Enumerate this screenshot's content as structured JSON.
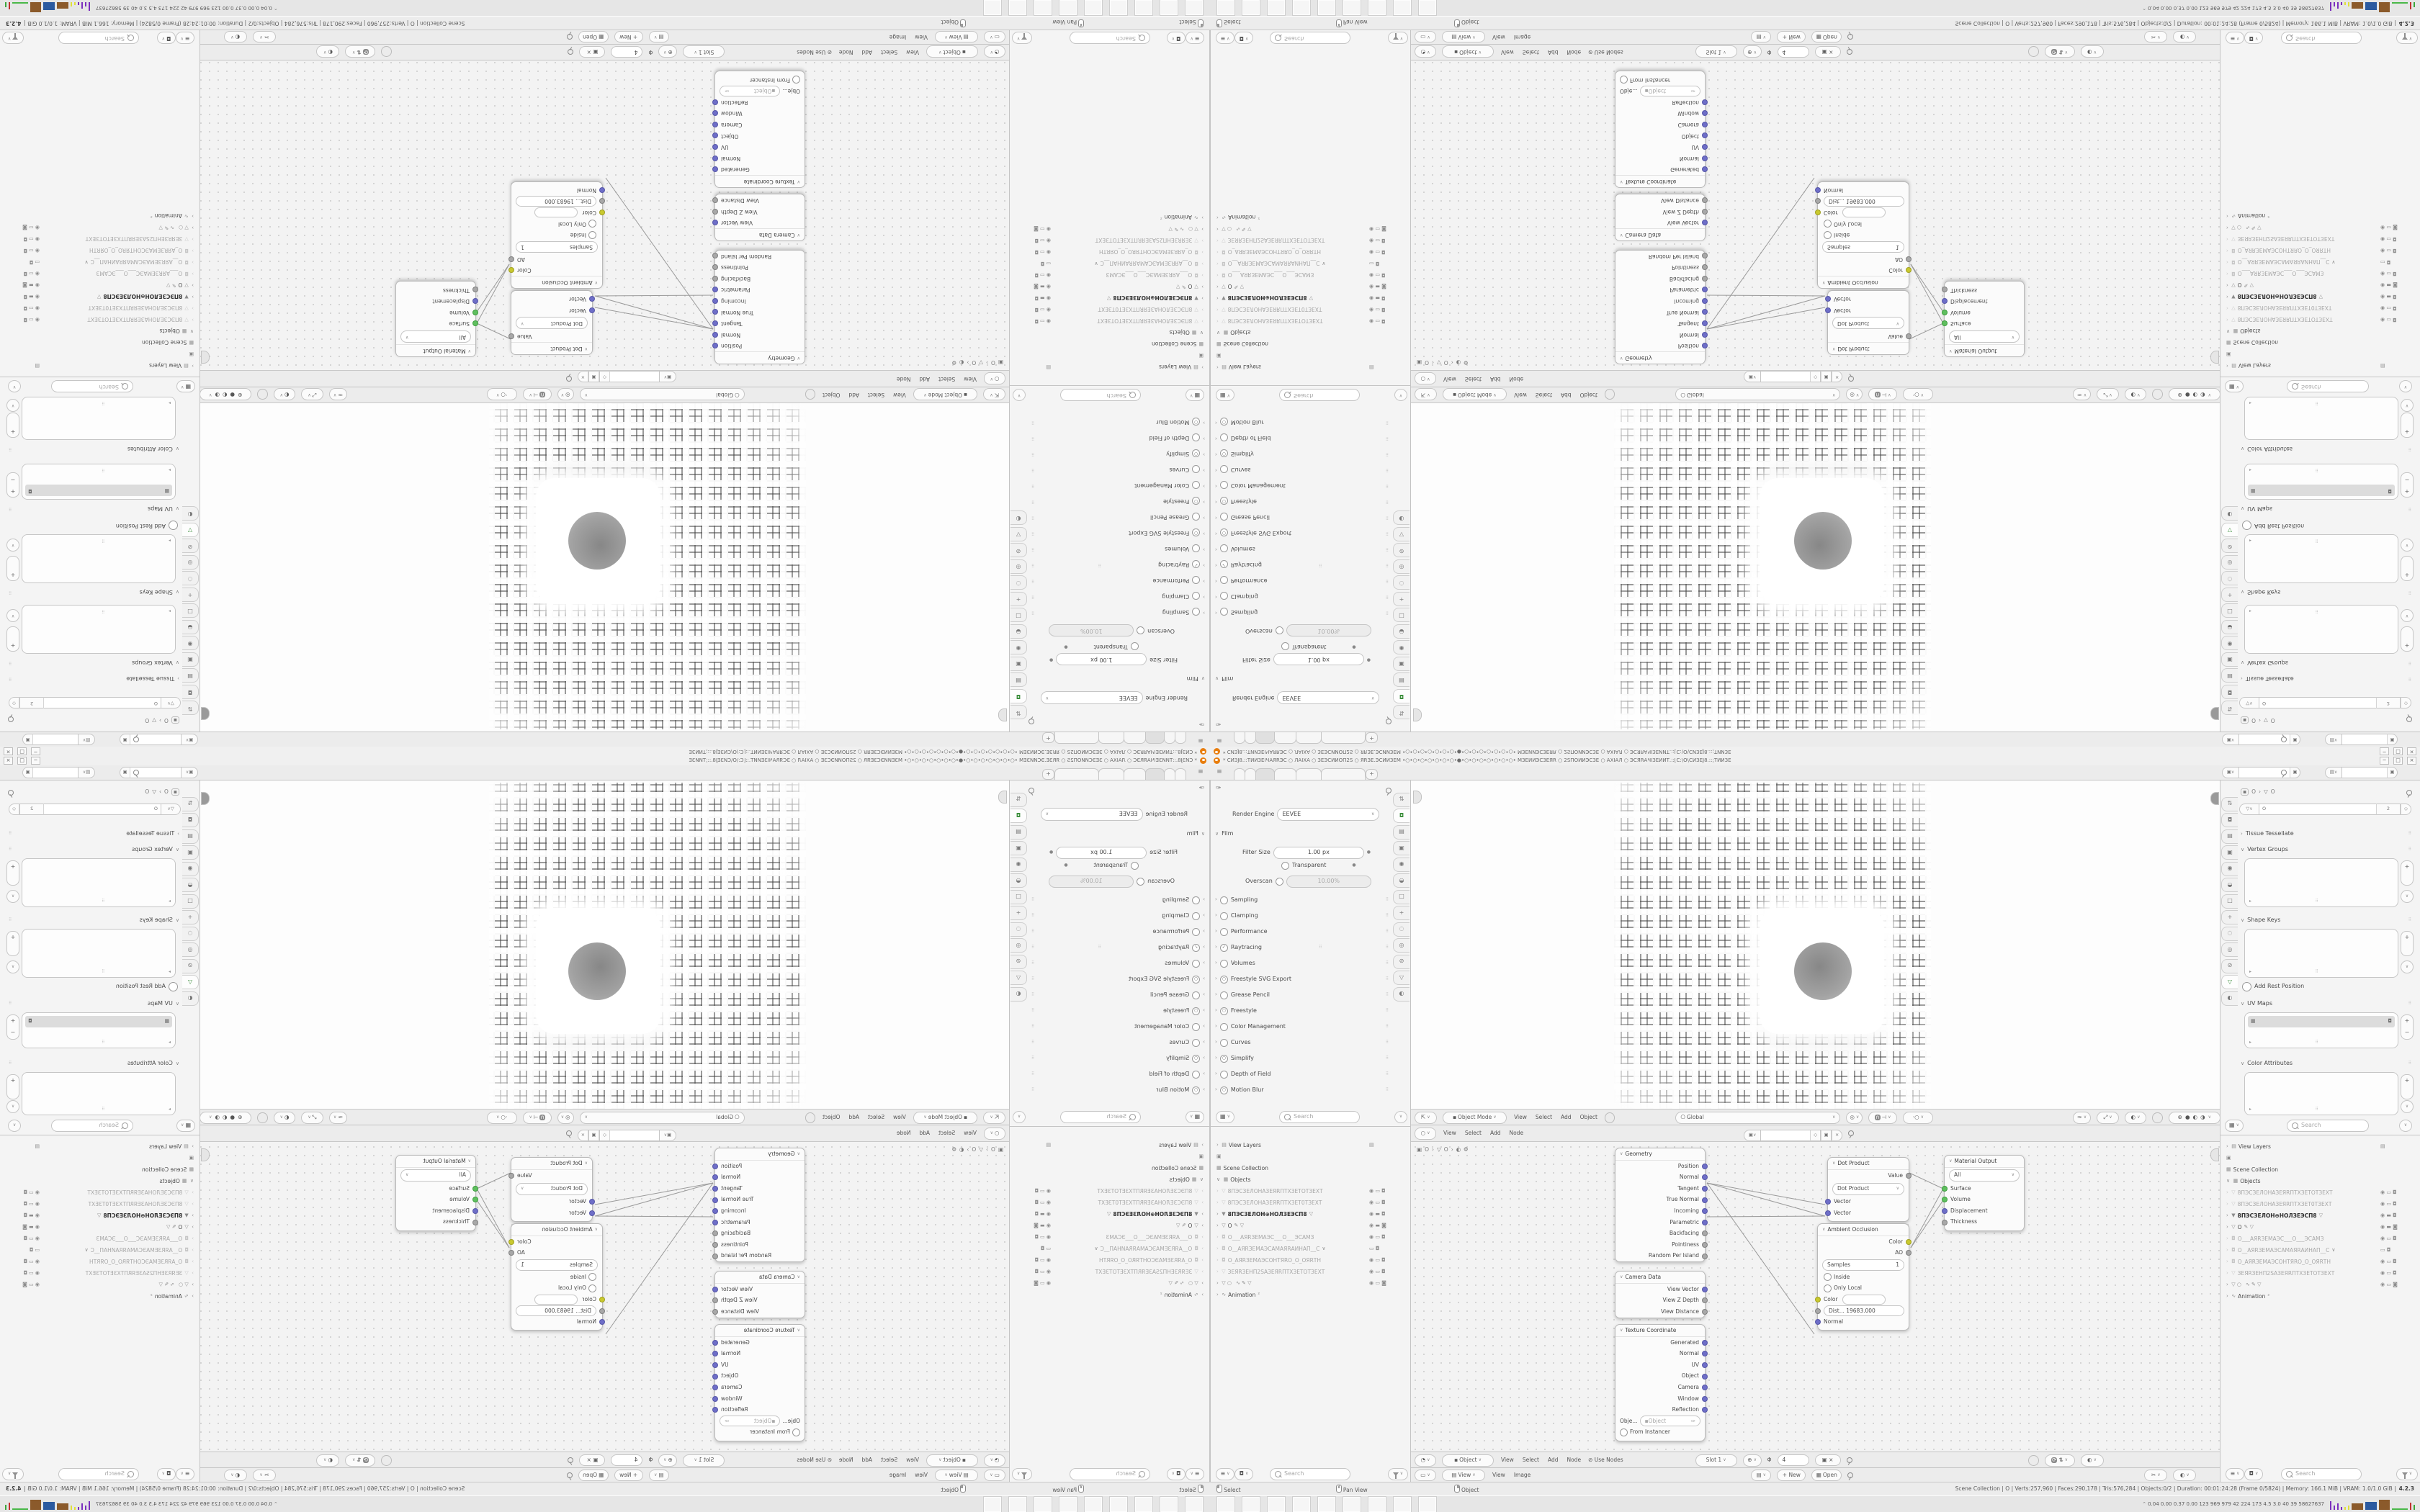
{
  "quadrant": {
    "titlebar": {
      "title": "* СИЗЈ8.::ТИИЗЕІЧАЯRЭС ○ ЛАІХА ○ ЗЕЭСИИОП2S ○ ЯRЗЕ.ЭСИИЗЕМ •○•○•○•○•○•○•○•●•○•○•○•○•○•○•○• МЗЕИИЭСЗЕЯR ○ 2SПОИИЭСЗЕ ○ АХІАЛ ○ ЭСЯRАЧІЗЕИИТ.::[С:\\О\\СИЗЕЈ8.::;ТИИЗЕ",
      "buttons": [
        "─",
        "□",
        "×"
      ]
    },
    "topbar": {
      "hamburger": "≡",
      "tabs": [
        "",
        "",
        "",
        "",
        "",
        ""
      ],
      "active_tab_index": 2,
      "new_tab": "+"
    },
    "properties_render": {
      "render_engine_label": "Render Engine",
      "render_engine_value": "EEVEE",
      "film_label": "Film",
      "filter_size_label": "Filter Size",
      "filter_size_value": "1.00 px",
      "transparent_label": "Transparent",
      "overscan_label": "Overscan",
      "overscan_value": "10.00%",
      "sections": [
        {
          "label": "Sampling",
          "chk": "",
          "extra": ""
        },
        {
          "label": "Clamping",
          "chk": "",
          "extra": ""
        },
        {
          "label": "Performance",
          "chk": "",
          "extra": ""
        },
        {
          "label": "Raytracing",
          "chk": "✓",
          "extra": "⠿"
        },
        {
          "label": "Volumes",
          "chk": "",
          "extra": ""
        },
        {
          "label": "Freestyle SVG Export",
          "chk": "○",
          "extra": ""
        },
        {
          "label": "Grease Pencil",
          "chk": "",
          "extra": ""
        },
        {
          "label": "Freestyle",
          "chk": "○",
          "extra": ""
        },
        {
          "label": "Color Management",
          "chk": "",
          "extra": ""
        },
        {
          "label": "Curves",
          "chk": "",
          "extra": ""
        },
        {
          "label": "Simplify",
          "chk": "○",
          "extra": ""
        },
        {
          "label": "Depth of Field",
          "chk": "",
          "extra": ""
        },
        {
          "label": "Motion Blur",
          "chk": "○",
          "extra": ""
        }
      ],
      "search_placeholder": "Search"
    },
    "tab_icons": [
      "⇅",
      "◘",
      "▤",
      "▣",
      "◉",
      "◒",
      "□",
      "+",
      "◌",
      "◎",
      "⊘",
      "▽",
      "◐"
    ],
    "outliner": {
      "rows": [
        {
          "cls": "top",
          "pre": "›  ▤",
          "label": "View Layers",
          "mid": "",
          "right": "▤"
        },
        {
          "cls": "top",
          "pre": "▣",
          "label": "",
          "mid": "",
          "right": ""
        },
        {
          "cls": "top",
          "pre": "▦",
          "label": "Scene Collection",
          "mid": "",
          "right": ""
        },
        {
          "cls": "top",
          "pre": "∨  ▦",
          "label": "Objects",
          "mid": "",
          "right": ""
        },
        {
          "cls": "dim",
          "pre": "›  ▽",
          "label": "8ПЭСЗЕЛОНАЗЕЯRПТХЗЕТОТЗЕХТ",
          "mid": "",
          "right": "◉ ▭ ◘"
        },
        {
          "cls": "dim",
          "pre": "›  ▽",
          "label": "8ПЭСЗЕЛОНАЗЕЯRПТХЗЕТ0ТЗЕХТ",
          "mid": "",
          "right": "◉ ▭ ◘"
        },
        {
          "cls": "sel",
          "pre": "›  ▼",
          "label": "8ПЭСЗЕЛОН⊕НОЛЗЕЭСП8",
          "mid": "▽",
          "right": "◉ ▬ ◘"
        },
        {
          "cls": "act",
          "pre": "›  ▽",
          "label": "O",
          "mid": "✎ ▽",
          "right": "◉ ▬ ◙"
        },
        {
          "cls": "dim",
          "pre": "›  ◘",
          "label": "О___АЯRЗЕМАЭС___О___ЭСАМЗ",
          "mid": "",
          "right": "◉ ▭ ◘"
        },
        {
          "cls": "dim",
          "pre": "›  ◘",
          "label": "О__АЯRЗЕМАЭСАМАЯRАИНАП__С",
          "mid": "∨",
          "right": "▭ ◘"
        },
        {
          "cls": "dim",
          "pre": "›  ◘",
          "label": "О_АЯRЗЕМАЭСОНТЯRО_О_ОЯRТН",
          "mid": "",
          "right": "◉ ▭ ◘"
        },
        {
          "cls": "dim",
          "pre": "›  ▽",
          "label": "ЗЕЯRЗЕНП2SАЗЕЯRПТХЗЕТОТЗЕХТ",
          "mid": "",
          "right": "◉ ▭ ◘"
        },
        {
          "cls": "top2",
          "pre": "›  ▽ ○",
          "label": "",
          "mid": "∿ ✎ ▽",
          "right": "◉ ▭ ◙"
        },
        {
          "cls": "top",
          "pre": "›  ∿",
          "label": "Animation",
          "mid": "²",
          "right": ""
        }
      ],
      "search_placeholder": "Search"
    },
    "viewport": {
      "mode": "Object Mode",
      "menus": [
        "View",
        "Select",
        "Add",
        "Object"
      ],
      "orientation": "Global"
    },
    "shader": {
      "menus": [
        "View",
        "Select",
        "Add",
        "Node"
      ],
      "breadcrumb": [
        "O",
        "O",
        "Φ"
      ],
      "geometry": {
        "title": "Geometry",
        "outputs": [
          {
            "label": "Position",
            "c": "v"
          },
          {
            "label": "Normal",
            "c": "v"
          },
          {
            "label": "Tangent",
            "c": "v"
          },
          {
            "label": "True Normal",
            "c": "v"
          },
          {
            "label": "Incoming",
            "c": "v"
          },
          {
            "label": "Parametric",
            "c": "v"
          },
          {
            "label": "Backfacing",
            "c": "f"
          },
          {
            "label": "Pointiness",
            "c": "f"
          },
          {
            "label": "Random Per Island",
            "c": "f"
          }
        ]
      },
      "camera_data": {
        "title": "Camera Data",
        "outputs": [
          {
            "label": "View Vector",
            "c": "v"
          },
          {
            "label": "View Z Depth",
            "c": "f"
          },
          {
            "label": "View Distance",
            "c": "f"
          }
        ]
      },
      "texture_coordinate": {
        "title": "Texture Coordinate",
        "outputs": [
          {
            "label": "Generated",
            "c": "v"
          },
          {
            "label": "Normal",
            "c": "v"
          },
          {
            "label": "UV",
            "c": "v"
          },
          {
            "label": "Object",
            "c": "v"
          },
          {
            "label": "Camera",
            "c": "v"
          },
          {
            "label": "Window",
            "c": "v"
          },
          {
            "label": "Reflection",
            "c": "v"
          }
        ],
        "object_label": "Obje...",
        "object_value": "Object",
        "from_instancer": "From Instancer"
      },
      "dot_product": {
        "title": "Dot Product",
        "output": "Value",
        "select": "Dot Product",
        "inputs": [
          {
            "label": "Vector",
            "c": "v"
          },
          {
            "label": "Vector",
            "c": "v"
          }
        ]
      },
      "material_output": {
        "title": "Material Output",
        "select": "All",
        "inputs": [
          {
            "label": "Surface",
            "c": "g"
          },
          {
            "label": "Volume",
            "c": "g"
          },
          {
            "label": "Displacement",
            "c": "v"
          },
          {
            "label": "Thickness",
            "c": "f"
          }
        ]
      },
      "ambient_occlusion": {
        "title": "Ambient Occlusion",
        "out_color": "Color",
        "out_ao": "AO",
        "samples_label": "Samples",
        "samples_value": "1",
        "inside": "Inside",
        "only_local": "Only Local",
        "color_in": "Color",
        "dist_value": "Dist...   19683.000",
        "normal_in": "Normal"
      }
    },
    "shader2": {
      "object": "Object",
      "menus": [
        "View",
        "Select",
        "Add",
        "Node"
      ],
      "use_nodes": "Use Nodes",
      "slot": "Slot 1",
      "phi": "Φ",
      "users": "4"
    },
    "image_editor": {
      "view": "View",
      "menus": [
        "View",
        "Image"
      ],
      "new_label": "+ New",
      "open_label": "Open"
    },
    "properties_data": {
      "crumb_obj": "O",
      "crumb_data": "O",
      "name_value": "O",
      "vertex_count": "2",
      "panels": {
        "tissue_tessellate": "Tissue Tessellate",
        "vertex_groups": "Vertex Groups",
        "shape_keys": "Shape Keys",
        "add_rest_position": "Add Rest Position",
        "uv_maps": "UV Maps",
        "color_attributes": "Color Attributes"
      },
      "search_placeholder": "Search"
    },
    "statusbar": {
      "hints": [
        {
          "label": "Select"
        },
        {
          "label": "Pan View"
        },
        {
          "label": "Object"
        }
      ],
      "info": "Scene Collection  |  O  |  Verts:257,960  |  Faces:290,178  |  Tris:576,284  |  Objects:0/2  |  Duration: 00:01:24:28 (Frame 0/5824)  |  Memory: 166.1 MiB  |  VRAM: 1.0/1.0 GiB  |",
      "version": "4.2.3"
    },
    "taskbar": {
      "icons": [
        {
          "name": "terminal"
        },
        {
          "name": "notepad"
        },
        {
          "name": "floppy-64"
        },
        {
          "name": "calculator"
        },
        {
          "name": "blender"
        },
        {
          "name": "calculator"
        },
        {
          "name": "screenshot"
        },
        {
          "name": "firefox"
        },
        {
          "name": "blender"
        }
      ],
      "tray_text": "0.04 0.00 0.37 0.00  123  969  979  42  224  173  4.5  3.0  40  39  58627637"
    }
  },
  "colors": {
    "accent_orange": "#e87d0d",
    "socket_vector": "#6e6ec8",
    "socket_color": "#c9c92f",
    "socket_shader": "#5fbf5f",
    "selection_gray": "#dcdcdc"
  }
}
